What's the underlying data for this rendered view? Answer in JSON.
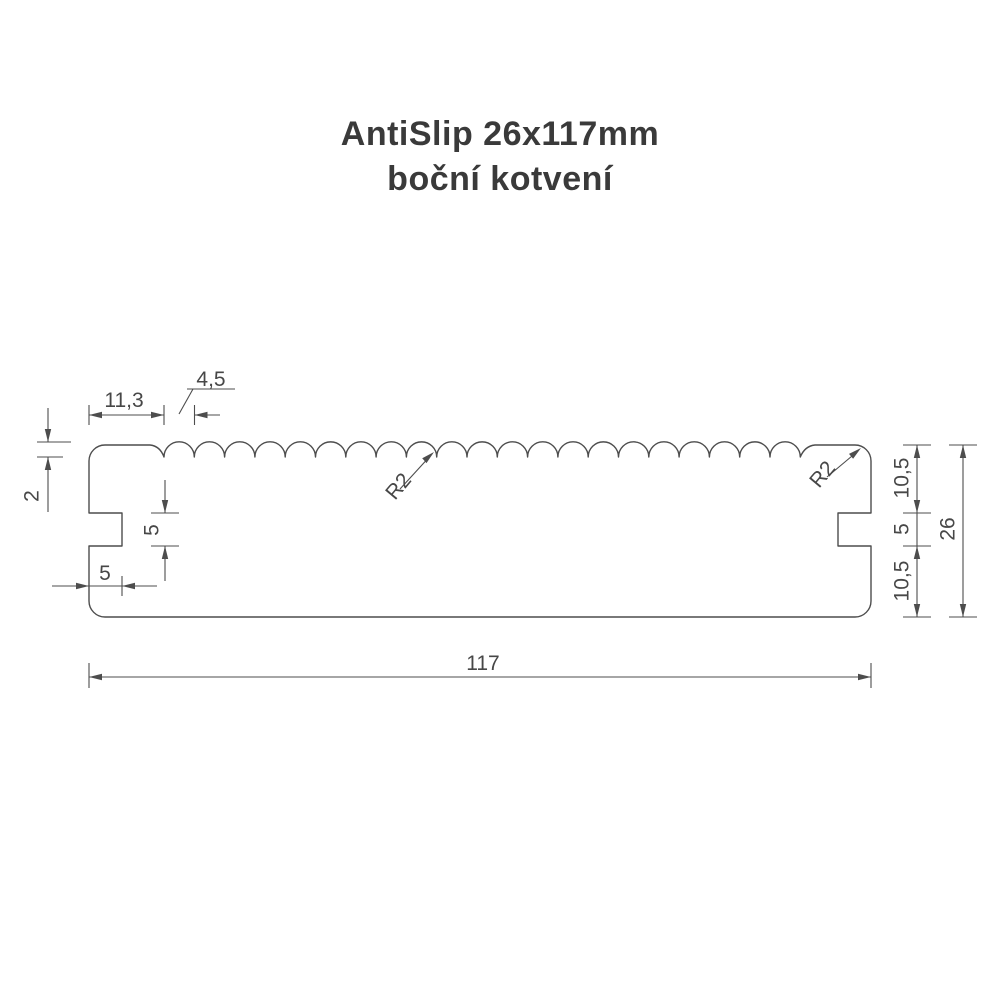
{
  "title": {
    "line1": "AntiSlip 26x117mm",
    "line2": "boční kotvení"
  },
  "dimensions": {
    "groove_start_offset": "11,3",
    "groove_pitch": "4,5",
    "groove_depth": "2",
    "left_notch_height": "5",
    "left_notch_depth": "5",
    "total_width": "117",
    "right_side_upper": "10,5",
    "right_notch_height": "5",
    "right_side_lower": "10,5",
    "total_height": "26",
    "groove_radius_label": "R2",
    "corner_radius_label": "R2"
  },
  "colors": {
    "line-color": "#4d4d4d",
    "title-color": "#3a3a3a",
    "background": "#ffffff"
  }
}
